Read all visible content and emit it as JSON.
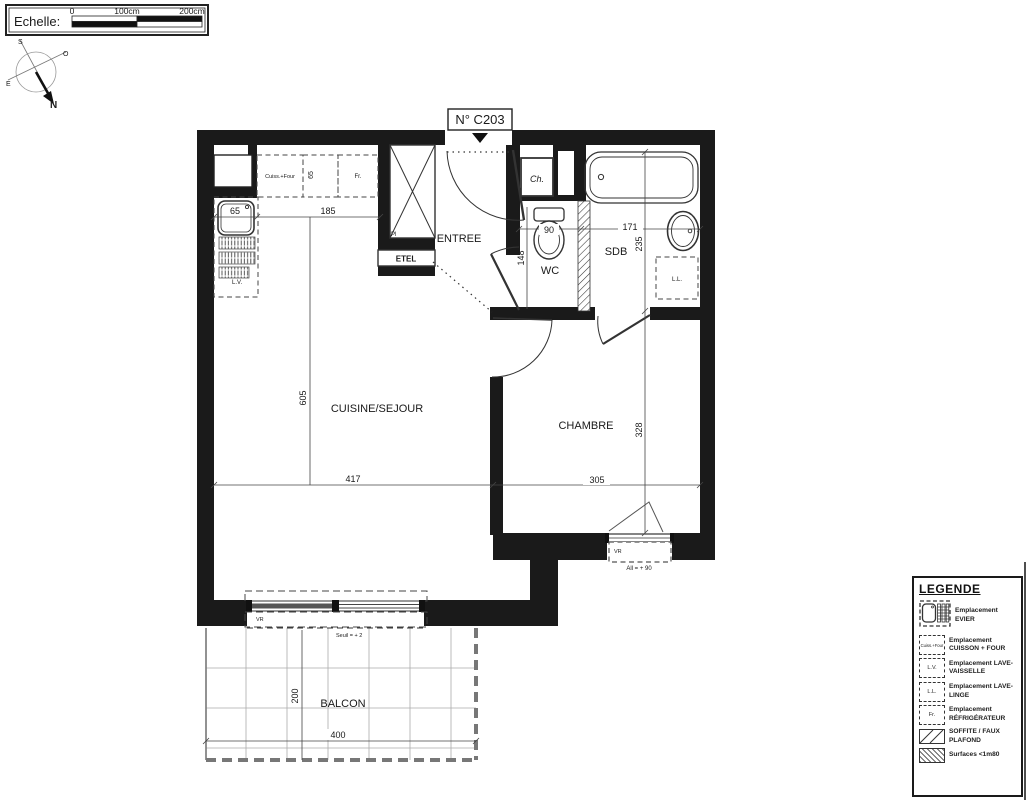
{
  "scalebar": {
    "label": "Echelle:",
    "t0": "0",
    "t100": "100cm",
    "t200": "200cm"
  },
  "compass": {
    "n": "N",
    "s": "S",
    "e": "E",
    "o": "O"
  },
  "plan": {
    "unit_label": "N° C203",
    "rooms": {
      "entree": "ENTREE",
      "wc": "WC",
      "sdb": "SDB",
      "sejour": "CUISINE/SEJOUR",
      "chambre": "CHAMBRE",
      "balcon": "BALCON"
    },
    "labels": {
      "ch": "Ch.",
      "etel": "ETEL",
      "pl": "Pl",
      "vr_sejour": "VR",
      "vr_chambre": "VR",
      "lv": "L.V.",
      "ll": "L.L.",
      "fr": "Fr.",
      "cuisson": "Cuiss.+Four"
    },
    "dims": {
      "niche_w": "65",
      "counter_w": "185",
      "counter_d": "65",
      "sejour_h": "605",
      "sejour_w": "417",
      "chambre_w": "305",
      "chambre_h": "328",
      "sdb_h": "235",
      "sdb_w": "171",
      "wc_w": "90",
      "wc_h": "148",
      "balcon_h": "200",
      "balcon_w": "400"
    },
    "notes": {
      "seuil": "Seuil = + 2",
      "allege": "All = + 90"
    }
  },
  "legend": {
    "title": "LEGENDE",
    "items": [
      {
        "tag": "",
        "label": "Emplacement EVIER"
      },
      {
        "tag": "Cuiss.+Four",
        "label": "Emplacement CUISSON + FOUR"
      },
      {
        "tag": "L.V.",
        "label": "Emplacement LAVE-VAISSELLE"
      },
      {
        "tag": "L.L.",
        "label": "Emplacement LAVE-LINGE"
      },
      {
        "tag": "Fr.",
        "label": "Emplacement RÉFRIGÉRATEUR"
      },
      {
        "tag": "",
        "label": "SOFFITE / FAUX PLAFOND"
      },
      {
        "tag": "",
        "label": "Surfaces <1m80"
      }
    ]
  },
  "colors": {
    "wall": "#1a1a1a",
    "line": "#333333",
    "grid": "#aaaaaa"
  }
}
